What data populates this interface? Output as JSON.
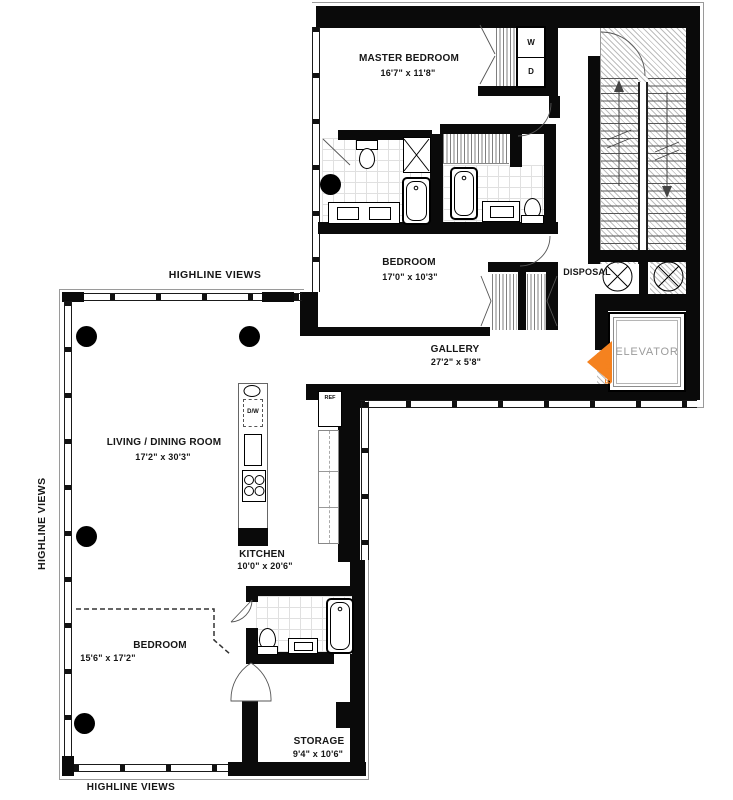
{
  "plan_title": "Two-wing loft apartment floor plan",
  "rooms": {
    "master_bedroom": {
      "name": "MASTER BEDROOM",
      "dims": "16'7\" x 11'8\""
    },
    "bedroom_upper": {
      "name": "BEDROOM",
      "dims": "17'0\" x 10'3\""
    },
    "gallery": {
      "name": "GALLERY",
      "dims": "27'2\" x 5'8\""
    },
    "living_dining": {
      "name": "LIVING / DINING ROOM",
      "dims": "17'2\" x 30'3\""
    },
    "kitchen": {
      "name": "KITCHEN",
      "dims": "10'0\" x 20'6\""
    },
    "bedroom_lower": {
      "name": "BEDROOM",
      "dims": "15'6\" x 17'2\""
    },
    "storage": {
      "name": "STORAGE",
      "dims": "9'4\" x 10'6\""
    },
    "elevator": {
      "label": "ELEVATOR"
    },
    "disposal": {
      "label": "DISPOSAL"
    }
  },
  "annotations": {
    "entry": "ENTRY",
    "highline_top": "HIGHLINE VIEWS",
    "highline_left": "HIGHLINE VIEWS",
    "highline_bottom": "HIGHLINE VIEWS"
  },
  "appliances": {
    "washer": "W",
    "dryer": "D",
    "dishwasher": "D/W",
    "refrigerator": "REF"
  },
  "colors": {
    "entry_orange": "#F5821F",
    "elevator_gray": "#9B9B9B",
    "wall_black": "#0A0A0A"
  }
}
